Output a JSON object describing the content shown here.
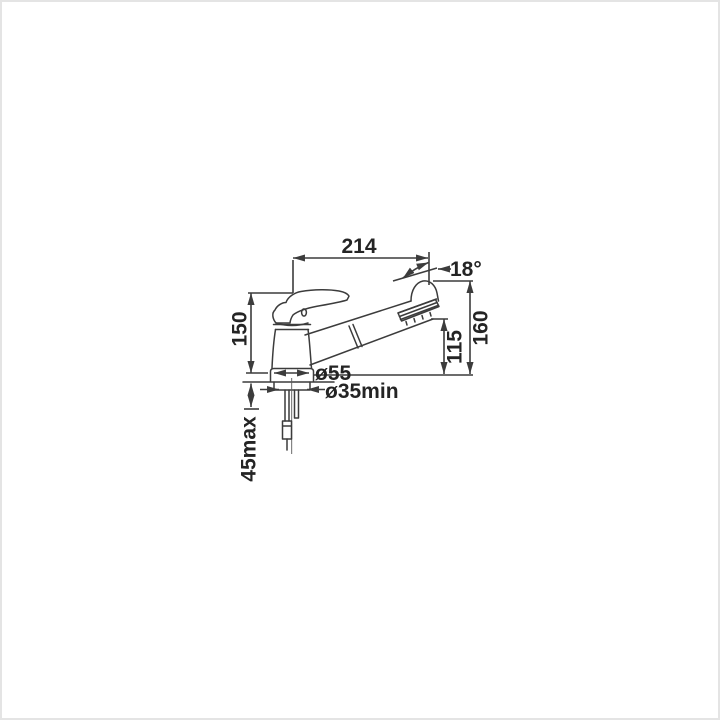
{
  "drawing": {
    "subject": "single-lever kitchen faucet with pull-out spray, dimensioned side view",
    "colors": {
      "line": "#3c3c3c",
      "text": "#242424",
      "background": "#ffffff",
      "frame": "#e4e4e4"
    },
    "dimensions": [
      {
        "id": "spout-reach",
        "label": "214",
        "orientation": "horizontal"
      },
      {
        "id": "spout-angle",
        "label": "18°",
        "orientation": "horizontal"
      },
      {
        "id": "fitting-height",
        "label": "150",
        "orientation": "vertical"
      },
      {
        "id": "spout-height",
        "label": "160",
        "orientation": "vertical"
      },
      {
        "id": "outlet-height",
        "label": "115",
        "orientation": "vertical"
      },
      {
        "id": "base-diameter",
        "label": "ø55",
        "orientation": "horizontal"
      },
      {
        "id": "mounting-hole-min",
        "label": "ø35min",
        "orientation": "horizontal"
      },
      {
        "id": "max-deck-thickness",
        "label": "45max",
        "orientation": "vertical"
      }
    ]
  }
}
